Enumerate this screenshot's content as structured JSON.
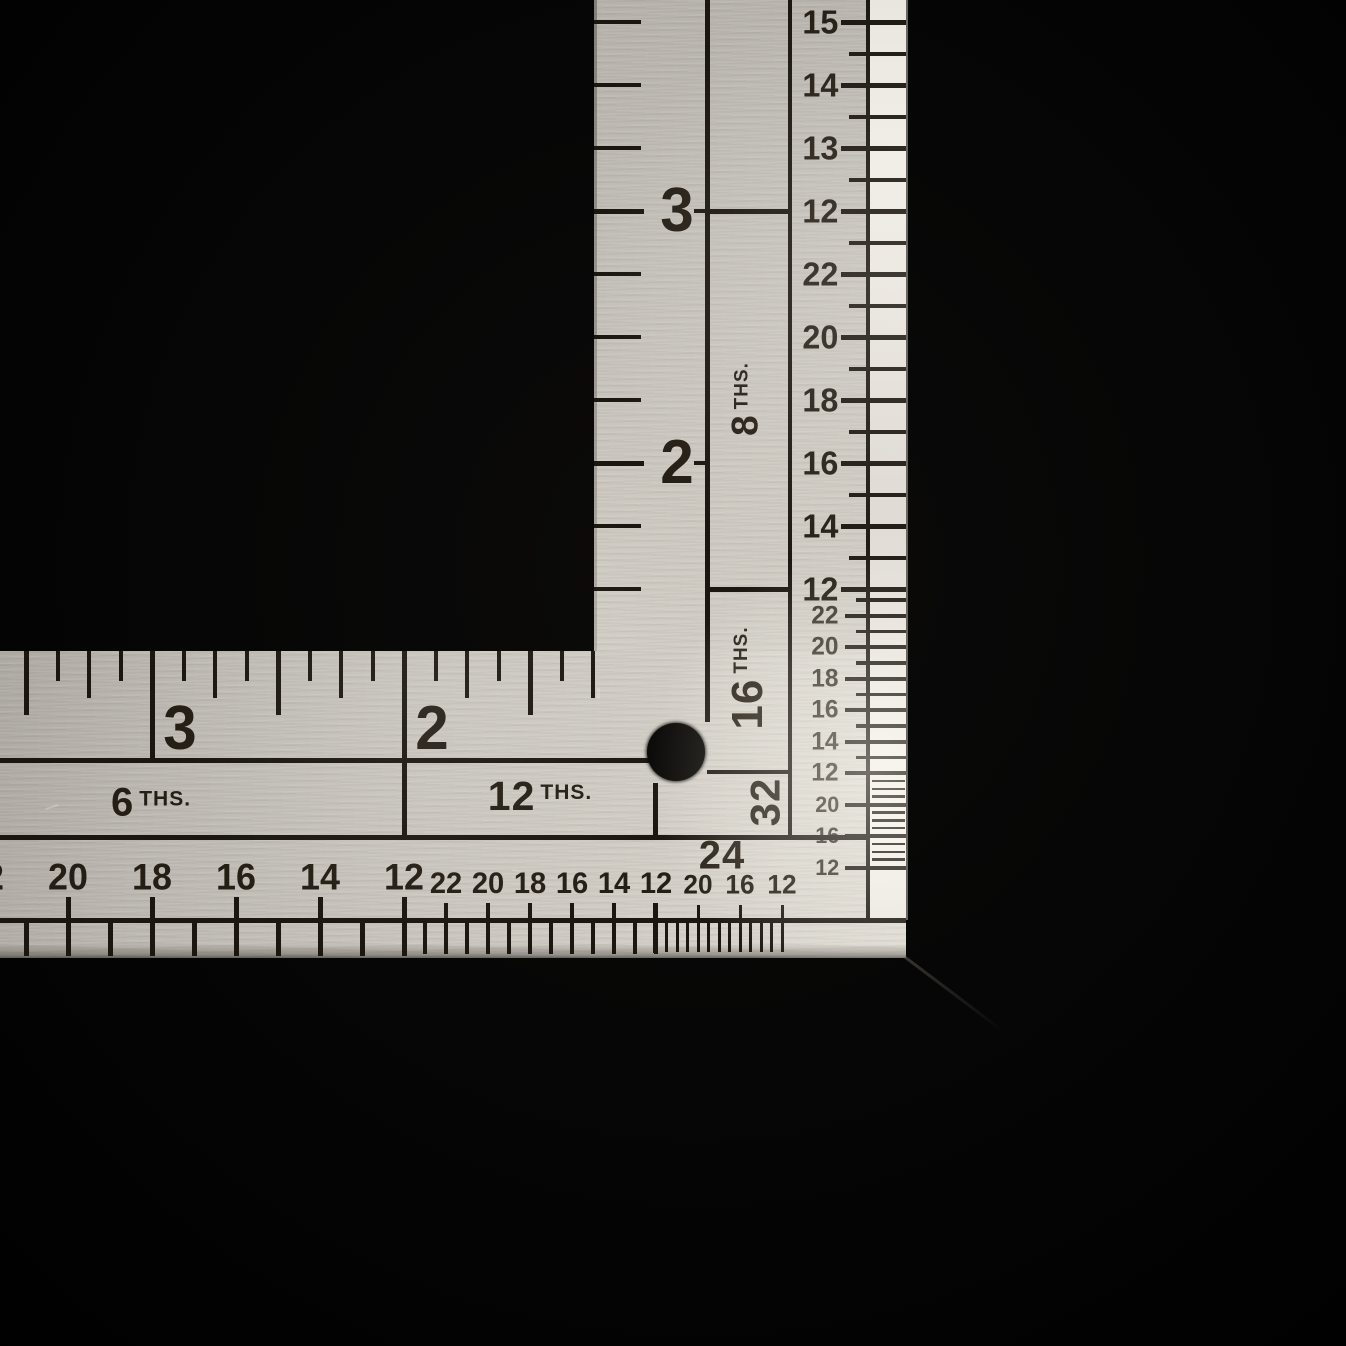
{
  "photo": {
    "subject": "L-shaped steel framing square (carpenter rule) photographed on a black background",
    "hole": "round black hang hole near inner corner"
  },
  "colors": {
    "background": "#050505",
    "metal_mid": "#c9c5bd",
    "metal_highlight": "#f2efe8",
    "etch": "#1c1610",
    "number_ink": "#251e15",
    "small_number_ink": "#39332b"
  },
  "vertical_arm": {
    "inch_scale_numbers": [
      "3",
      "2"
    ],
    "fraction_boxes": [
      {
        "value": "8",
        "suffix": "THS."
      },
      {
        "value": "16",
        "suffix": "THS."
      },
      {
        "value": "32",
        "suffix": ""
      }
    ],
    "edge_scales": {
      "quarters": [
        "15",
        "14",
        "13",
        "12"
      ],
      "eighths": [
        "22",
        "20",
        "18",
        "16",
        "14",
        "12"
      ],
      "sixteenths": [
        "22",
        "20",
        "18",
        "16",
        "14",
        "12"
      ],
      "thirtyseconds": [
        "20",
        "16",
        "12"
      ]
    }
  },
  "horizontal_arm": {
    "inch_scale_numbers": [
      "3",
      "2"
    ],
    "fraction_labels": [
      {
        "value": "6",
        "suffix": "THS."
      },
      {
        "value": "12",
        "suffix": "THS."
      },
      {
        "value": "24",
        "suffix": ""
      }
    ],
    "edge_scales": {
      "sixths": [
        "22",
        "20",
        "18",
        "16",
        "14",
        "12"
      ],
      "twelfths": [
        "22",
        "20",
        "18",
        "16",
        "14",
        "12"
      ],
      "twentyfourths": [
        "20",
        "16",
        "12"
      ]
    }
  }
}
